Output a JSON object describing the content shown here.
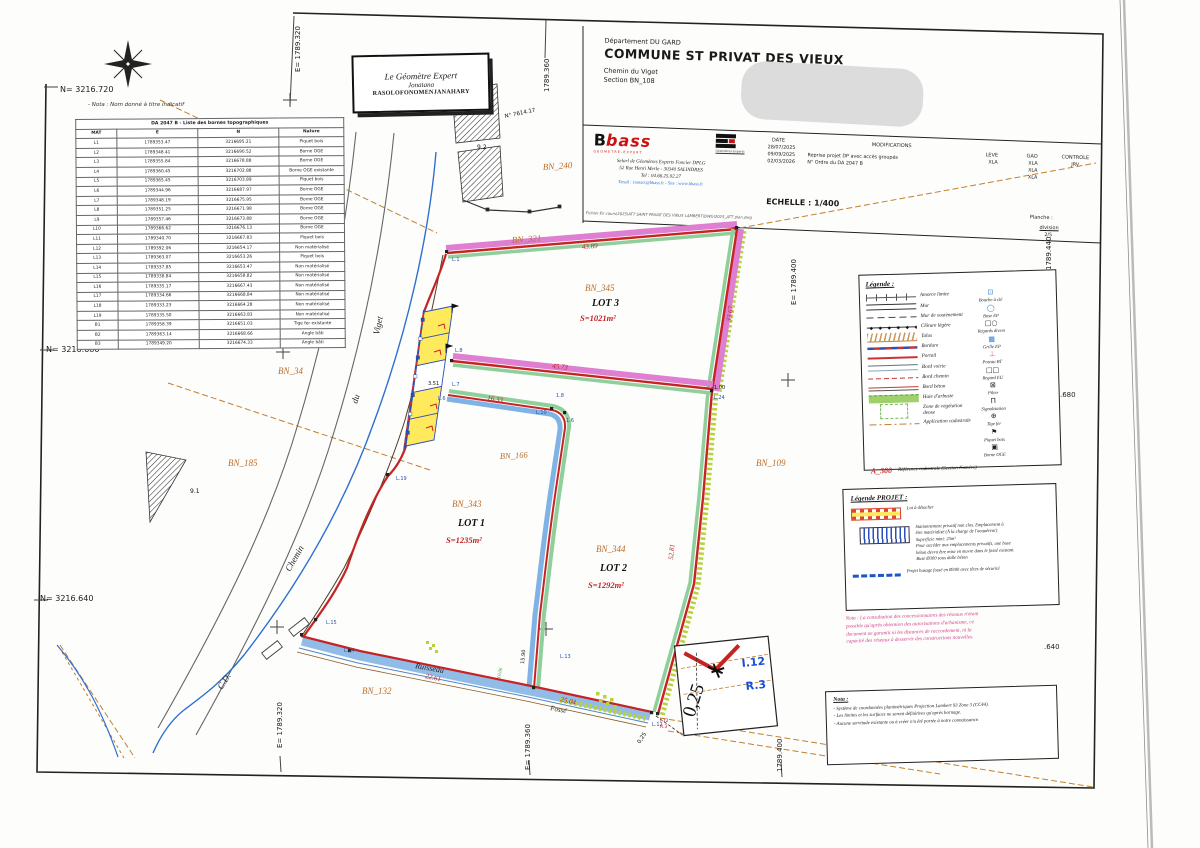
{
  "header": {
    "department": "Département DU GARD",
    "commune": "COMMUNE ST PRIVAT DES VIEUX",
    "address": "Chemin du Viget",
    "section": "Section BN_108"
  },
  "firm": {
    "logo_b": "B",
    "logo_bass": "bass",
    "logo_tagline": "GEOMETRE-EXPERT",
    "ge_caption": "Géomètres-Experts",
    "line1": "Selarl de Géomètres Experts Foncier DPLG",
    "line2": "52 Rue Henri Merle - 30340 SALINDRES",
    "line3": "Tel : 04.66.25.02.27",
    "line4": "Email : contact@bbass.fr - Site : www.bbass.fr",
    "file_line": "Fichier En cours\\2025\\ATT SAINT PRIVAT DES VIEUX LAMBERT\\DWG\\2025_ATT plan.dwg"
  },
  "revisions": {
    "date_label": "DATE",
    "dates": [
      "28/07/2025",
      "09/09/2025",
      "02/03/2026"
    ],
    "modifications_label": "MODIFICATIONS",
    "modifications": [
      "Reprise projet DP avec accès groupés",
      "N° Ordre du DA 2047 B"
    ],
    "leve_label": "LEVE",
    "leve": "XLA",
    "gao_label": "GAO",
    "gao": [
      "XLA",
      "XLA",
      "XLA"
    ],
    "controle_label": "CONTROLE",
    "controle": "JRV",
    "echelle": "ECHELLE : 1/400",
    "planche_label": "Planche :",
    "planche_name": "division",
    "planche_num": "2/5"
  },
  "stamp": {
    "line1": "Le Géomètre Expert",
    "line2": "Jonatana",
    "line3": "RASOLOFONOMENJANAHARY"
  },
  "table": {
    "title": "DA 2047 B - Liste des bornes topographiques",
    "columns": [
      "MAT",
      "E",
      "N",
      "Nature"
    ],
    "rows": [
      [
        "L1",
        "1789353.47",
        "3216695.21",
        "Piquet bois"
      ],
      [
        "L2",
        "1789348.41",
        "3216690.52",
        "Borne OGE"
      ],
      [
        "L3",
        "1789355.84",
        "3216678.88",
        "Borne OGE"
      ],
      [
        "L4",
        "1789360.45",
        "3216702.88",
        "Borne OGE existante"
      ],
      [
        "L5",
        "1789365.45",
        "3216703.89",
        "Piquet bois"
      ],
      [
        "L6",
        "1789344.96",
        "3216687.97",
        "Borne OGE"
      ],
      [
        "L7",
        "1789348.19",
        "3216675.95",
        "Borne OGE"
      ],
      [
        "L8",
        "1789351.25",
        "3216671.98",
        "Borne OGE"
      ],
      [
        "L9",
        "1789357.46",
        "3216673.88",
        "Borne OGE"
      ],
      [
        "L10",
        "1789366.62",
        "3216676.13",
        "Borne OGE"
      ],
      [
        "L11",
        "1789340.70",
        "3216667.83",
        "Piquet bois"
      ],
      [
        "L12",
        "1789392.06",
        "3216654.17",
        "Non matérialisé"
      ],
      [
        "L13",
        "1789363.07",
        "3216653.26",
        "Piquet bois"
      ],
      [
        "L14",
        "1789337.85",
        "3216653.47",
        "Non matérialisé"
      ],
      [
        "L15",
        "1789338.84",
        "3216658.82",
        "Non matérialisé"
      ],
      [
        "L16",
        "1789335.17",
        "3216667.43",
        "Non matérialisé"
      ],
      [
        "L17",
        "1789334.66",
        "3216668.84",
        "Non matérialisé"
      ],
      [
        "L18",
        "1789333.23",
        "3216664.28",
        "Non matérialisé"
      ],
      [
        "L19",
        "1789335.50",
        "3216663.83",
        "Non matérialisé"
      ],
      [
        "B1",
        "1789358.39",
        "3216651.03",
        "Tige fer existante"
      ],
      [
        "B2",
        "1789363.14",
        "3216668.66",
        "Angle bâti"
      ],
      [
        "B3",
        "1789349.20",
        "3216674.33",
        "Angle bâti"
      ]
    ]
  },
  "legend": {
    "title": "Légende :",
    "line_items": [
      {
        "k": "amorce",
        "label": "Amorce limite"
      },
      {
        "k": "mur",
        "label": "Mur"
      },
      {
        "k": "mursout",
        "label": "Mur de soutènement"
      },
      {
        "k": "cloture",
        "label": "Clôture légère"
      },
      {
        "k": "talus",
        "label": "Talus"
      },
      {
        "k": "bordure",
        "label": "Bordure"
      },
      {
        "k": "portail",
        "label": "Portail"
      },
      {
        "k": "voirie",
        "label": "Bord voirie"
      },
      {
        "k": "chemin",
        "label": "Bord chemin"
      },
      {
        "k": "beton",
        "label": "Bord béton"
      },
      {
        "k": "haie",
        "label": "Haie d'arbuste"
      },
      {
        "k": "zoneveg",
        "label": "Zone de végétation dense"
      },
      {
        "k": "application",
        "label": "Application cadastrale"
      }
    ],
    "symbol_items": [
      {
        "label": "Bouche à clé",
        "icon": "bouche-a-cle-icon",
        "glyph": "⊡",
        "color": "#2b7fd4"
      },
      {
        "label": "Buse EP",
        "icon": "buse-ep-icon",
        "glyph": "◯",
        "color": "#2b7fd4"
      },
      {
        "label": "Regards divers",
        "icon": "regards-divers-icon",
        "glyph": "□○",
        "color": "#222222"
      },
      {
        "label": "Grille EP",
        "icon": "grille-ep-icon",
        "glyph": "▦",
        "color": "#2b7fd4"
      },
      {
        "label": "Poteau BT",
        "icon": "poteau-bt-icon",
        "glyph": "⊥",
        "color": "#d44fb0"
      },
      {
        "label": "Regard EU",
        "icon": "regard-eu-icon",
        "glyph": "□□",
        "color": "#222222"
      },
      {
        "label": "Pilier",
        "icon": "pilier-icon",
        "glyph": "⊠",
        "color": "#222222"
      },
      {
        "label": "Signalisation",
        "icon": "signalisation-icon",
        "glyph": "Π",
        "color": "#222222"
      },
      {
        "label": "Tige fer",
        "icon": "tige-fer-icon",
        "glyph": "⊕",
        "color": "#222222"
      },
      {
        "label": "Piquet bois",
        "icon": "piquet-bois-icon",
        "glyph": "⚑",
        "color": "#222222"
      },
      {
        "label": "Borne OGE",
        "icon": "borne-oge-icon",
        "glyph": "▣",
        "color": "#222222"
      }
    ],
    "cadastral_ref": {
      "code": "A_300",
      "label": "Référence cadastrale (Section Numéro)"
    }
  },
  "project_legend": {
    "title": "Légende PROJET :",
    "items": [
      {
        "k": "lot",
        "text": "Lot à détacher"
      },
      {
        "k": "parking",
        "text": "Stationnement privatif non clos. Emplacement à\nêtre matérialisé (À la charge de l'acquéreur)\nSuperficie mini: 25m²\nPour accéder aux emplacements privatifs, une buse\nbéton devra être mise en œuvre dans le fossé existant.\nBuse Ø300 sous dalle béton"
      },
      {
        "k": "busage",
        "text": "Projet busage fossé en Ø300 avec têtes de sécurité"
      }
    ]
  },
  "nota_pink": "Nota : La consultation des concessionnaires des réseaux n'étant\npossible qu'après obtention des autorisations d'urbanisme, ce\ndocument ne garantit ni les distances de raccordement, ni la\ncapacité des réseaux à desservir des constructions nouvelles.",
  "nota_box": {
    "title": "Nota :",
    "items": [
      "- Système de coordonnées planimétriques Projection Lambert 93 Zone 3 (CC44).",
      "- Les limites et les surfaces ne seront définitives qu'après bornage.",
      "- Aucune servitude existante ou à créer n'a été portée à notre connaissance."
    ]
  },
  "colors": {
    "boundary_red": "#c62323",
    "band_magenta": "#df7fd2",
    "band_green": "#8fcf9b",
    "band_blue": "#7fb2e5",
    "hatch_chartreuse": "#b9d23a",
    "stream_blue": "#92bce8",
    "parking_yellow": "#ffe95c",
    "label_orange": "#bb6f2d",
    "dim_red": "#cc2222",
    "point_blue": "#2b50b8",
    "cadastral_brown": "#c08030",
    "nota_pink": "#d0408e"
  },
  "plan": {
    "labels": [
      {
        "t": "N= 3216.720",
        "x": 60,
        "y": 92,
        "c": "coord",
        "s": 8
      },
      {
        "t": "N= 3216.680",
        "x": 46,
        "y": 352,
        "c": "coord",
        "s": 8
      },
      {
        "t": "N= 3216.640",
        "x": 40,
        "y": 601,
        "c": "coord",
        "s": 8
      },
      {
        "t": "E= 1789.320",
        "x": 300,
        "y": 72,
        "c": "coord",
        "s": 7,
        "r": -90
      },
      {
        "t": "1789.360",
        "x": 549,
        "y": 92,
        "c": "coord",
        "s": 7,
        "r": -90
      },
      {
        "t": "E= 1789.400",
        "x": 796,
        "y": 305,
        "c": "coord",
        "s": 7,
        "r": -90
      },
      {
        "t": "1789.440",
        "x": 1051,
        "y": 270,
        "c": "coord",
        "s": 7,
        "r": -90
      },
      {
        "t": ".680",
        "x": 1060,
        "y": 397,
        "c": "coord",
        "s": 7
      },
      {
        "t": ".640",
        "x": 1044,
        "y": 649,
        "c": "coord",
        "s": 7
      },
      {
        "t": "E= 1789.320",
        "x": 282,
        "y": 748,
        "c": "coord",
        "s": 7,
        "r": -90
      },
      {
        "t": "E= 1789.360",
        "x": 530,
        "y": 770,
        "c": "coord",
        "s": 7,
        "r": -90
      },
      {
        "t": "1789.400",
        "x": 782,
        "y": 772,
        "c": "coord",
        "s": 7,
        "r": -90
      },
      {
        "t": "- Nota : Nom donné à titre indicatif",
        "x": 88,
        "y": 106,
        "c": "note",
        "s": 5.5
      },
      {
        "t": "BN_321",
        "x": 512,
        "y": 243,
        "c": "orange",
        "s": 9,
        "r": -4
      },
      {
        "t": "BN_240",
        "x": 543,
        "y": 170,
        "c": "orange",
        "s": 9,
        "r": -4
      },
      {
        "t": "BN_345",
        "x": 585,
        "y": 291,
        "c": "orange",
        "s": 9
      },
      {
        "t": "LOT 3",
        "x": 592,
        "y": 306,
        "c": "lotlbl",
        "s": 10
      },
      {
        "t": "S=1021m²",
        "x": 580,
        "y": 321,
        "c": "area",
        "s": 8.5
      },
      {
        "t": "BN_34",
        "x": 278,
        "y": 374,
        "c": "orange",
        "s": 9
      },
      {
        "t": "BN_185",
        "x": 228,
        "y": 466,
        "c": "orange",
        "s": 9
      },
      {
        "t": "BN_166",
        "x": 500,
        "y": 459,
        "c": "orange",
        "s": 8.5,
        "r": -3
      },
      {
        "t": "BN_343",
        "x": 452,
        "y": 507,
        "c": "orange",
        "s": 9
      },
      {
        "t": "LOT 1",
        "x": 458,
        "y": 526,
        "c": "lotlbl",
        "s": 10
      },
      {
        "t": "S=1235m²",
        "x": 446,
        "y": 543,
        "c": "area",
        "s": 8.5
      },
      {
        "t": "BN_344",
        "x": 596,
        "y": 552,
        "c": "orange",
        "s": 9
      },
      {
        "t": "LOT 2",
        "x": 600,
        "y": 571,
        "c": "lotlbl",
        "s": 10
      },
      {
        "t": "S=1292m²",
        "x": 588,
        "y": 588,
        "c": "area",
        "s": 8.5
      },
      {
        "t": "BN_109",
        "x": 756,
        "y": 466,
        "c": "orange",
        "s": 9
      },
      {
        "t": "BN_132",
        "x": 362,
        "y": 694,
        "c": "orange",
        "s": 9
      },
      {
        "t": "Viget",
        "x": 379,
        "y": 335,
        "c": "road",
        "s": 9,
        "r": -78
      },
      {
        "t": "du",
        "x": 357,
        "y": 404,
        "c": "road",
        "s": 9,
        "r": -72
      },
      {
        "t": "Chemin",
        "x": 290,
        "y": 572,
        "c": "road",
        "s": 9,
        "r": -60
      },
      {
        "t": "C.D.",
        "x": 222,
        "y": 690,
        "c": "road",
        "s": 9,
        "r": -58
      },
      {
        "t": "Ruisseau",
        "x": 415,
        "y": 668,
        "c": "road",
        "s": 8,
        "r": 10
      },
      {
        "t": "Fossé",
        "x": 550,
        "y": 710,
        "c": "road",
        "s": 7,
        "r": 11
      },
      {
        "t": "43.89",
        "x": 582,
        "y": 249,
        "c": "meas",
        "s": 7,
        "r": -4
      },
      {
        "t": "33.67",
        "x": 731,
        "y": 322,
        "c": "meas",
        "s": 7,
        "r": -82
      },
      {
        "t": "45.73",
        "x": 552,
        "y": 368,
        "c": "meas",
        "s": 7,
        "r": 6
      },
      {
        "t": "16.33",
        "x": 487,
        "y": 400,
        "c": "meas",
        "s": 7,
        "r": 9
      },
      {
        "t": "52.81",
        "x": 673,
        "y": 560,
        "c": "meas",
        "s": 7,
        "r": -85
      },
      {
        "t": "22.61",
        "x": 425,
        "y": 678,
        "c": "meas",
        "s": 7,
        "r": 12
      },
      {
        "t": "25.04",
        "x": 560,
        "y": 701,
        "c": "meas",
        "s": 7,
        "r": 14
      },
      {
        "t": "9.2",
        "x": 477,
        "y": 149,
        "c": "tiny",
        "s": 6
      },
      {
        "t": "9.1",
        "x": 190,
        "y": 493,
        "c": "tiny",
        "s": 6
      },
      {
        "t": "N° 7614.17",
        "x": 505,
        "y": 118,
        "c": "tiny",
        "s": 5.5,
        "r": -12
      },
      {
        "t": "L.1",
        "x": 452,
        "y": 261,
        "c": "pt",
        "s": 5
      },
      {
        "t": "L.8",
        "x": 455,
        "y": 352,
        "c": "pt",
        "s": 5
      },
      {
        "t": "L.7",
        "x": 452,
        "y": 386,
        "c": "pt",
        "s": 5
      },
      {
        "t": "L.6",
        "x": 438,
        "y": 400,
        "c": "pt",
        "s": 5
      },
      {
        "t": "1.8",
        "x": 556,
        "y": 397,
        "c": "pt",
        "s": 5
      },
      {
        "t": "1.6",
        "x": 566,
        "y": 422,
        "c": "pt",
        "s": 5
      },
      {
        "t": "L.10",
        "x": 536,
        "y": 414,
        "c": "pt",
        "s": 5
      },
      {
        "t": "L.19",
        "x": 396,
        "y": 480,
        "c": "pt",
        "s": 5
      },
      {
        "t": "L.15",
        "x": 326,
        "y": 624,
        "c": "pt",
        "s": 5
      },
      {
        "t": "L.14",
        "x": 344,
        "y": 652,
        "c": "pt",
        "s": 5
      },
      {
        "t": "L.13",
        "x": 560,
        "y": 658,
        "c": "pt",
        "s": 5
      },
      {
        "t": "L.12",
        "x": 652,
        "y": 726,
        "c": "pt",
        "s": 5
      },
      {
        "t": "1.00",
        "x": 714,
        "y": 389,
        "c": "tiny",
        "s": 5
      },
      {
        "t": "L.24",
        "x": 714,
        "y": 399,
        "c": "pt",
        "s": 5
      },
      {
        "t": "3.51",
        "x": 428,
        "y": 385,
        "c": "tiny",
        "s": 5
      },
      {
        "t": "15.90",
        "x": 524,
        "y": 664,
        "c": "tiny",
        "s": 5,
        "r": -85
      },
      {
        "t": "10.06",
        "x": 500,
        "y": 679,
        "c": "greenlab",
        "s": 5,
        "r": -78
      },
      {
        "t": "0,25",
        "x": 694,
        "y": 718,
        "c": "insetbig",
        "s": 19,
        "r": -72
      },
      {
        "t": "I.12",
        "x": 742,
        "y": 667,
        "c": "insetblue",
        "s": 11,
        "r": -6
      },
      {
        "t": "R.3",
        "x": 746,
        "y": 690,
        "c": "insetblue",
        "s": 11,
        "r": -6
      },
      {
        "t": "I.12",
        "x": 660,
        "y": 722,
        "c": "insetred",
        "s": 4.5
      },
      {
        "t": "R.3",
        "x": 660,
        "y": 728,
        "c": "insetred",
        "s": 4.5
      },
      {
        "t": "0,25",
        "x": 640,
        "y": 744,
        "c": "tiny",
        "s": 5.5,
        "r": -58
      }
    ]
  }
}
